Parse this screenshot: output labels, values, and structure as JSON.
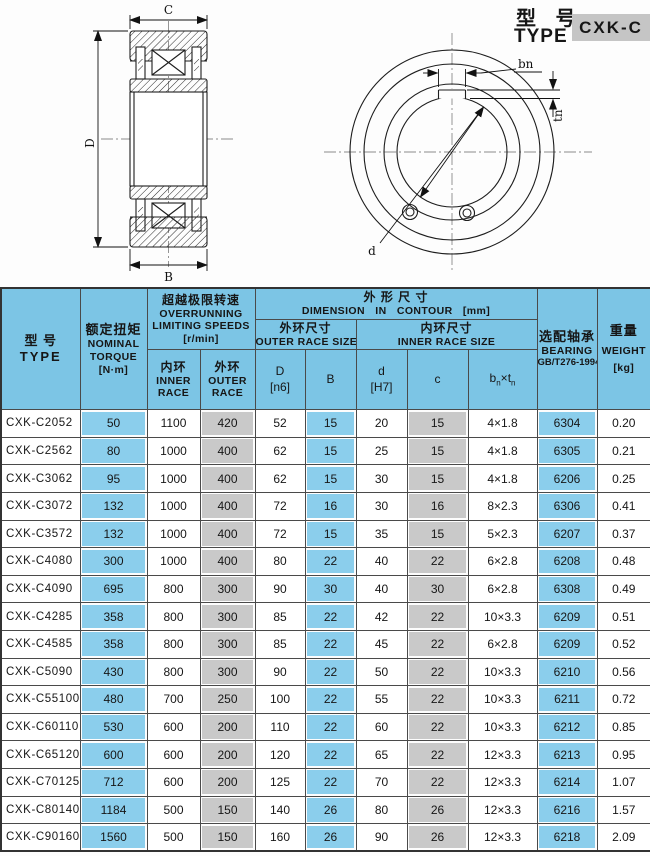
{
  "title": {
    "cn": "型 号",
    "en": "TYPE",
    "model": "CXK-C"
  },
  "drawing": {
    "labels": {
      "C": "C",
      "D": "D",
      "B": "B",
      "bn": "bn",
      "tn": "tn",
      "d": "d"
    }
  },
  "colors": {
    "header_blue": "#7CC5E5",
    "cell_blue": "#8BCEEC",
    "cell_gray": "#C9C9C9",
    "badge_gray": "#C5C5C5"
  },
  "table": {
    "header": {
      "type_cn": "型  号",
      "type_en": "TYPE",
      "torque_cn": "额定扭矩",
      "torque_l1": "NOMINAL",
      "torque_l2": "TORQUE",
      "torque_l3": "[N·m]",
      "overrun_cn": "超越极限转速",
      "overrun_l1": "OVERRUNNING",
      "overrun_l2": "LIMITING SPEEDS",
      "overrun_l3": "[r/min]",
      "inner_cn": "内环",
      "inner_l1": "INNER",
      "inner_l2": "RACE",
      "outer_cn": "外环",
      "outer_l1": "OUTER",
      "outer_l2": "RACE",
      "dim_cn": "外  形  尺  寸",
      "dim_en": "DIMENSION  IN  CONTOUR  [mm]",
      "outer_size_cn": "外环尺寸",
      "outer_size_en": "OUTER RACE SIZE",
      "inner_size_cn": "内环尺寸",
      "inner_size_en": "INNER RACE SIZE",
      "col_D_l1": "D",
      "col_D_l2": "[n6]",
      "col_B": "B",
      "col_d_l1": "d",
      "col_d_l2": "[H7]",
      "col_c": "c",
      "col_bt": {
        "base1": "b",
        "sub1": "n",
        "times": "×",
        "base2": "t",
        "sub2": "n"
      },
      "bearing_cn": "选配轴承",
      "bearing_l1": "BEARING",
      "bearing_l2": "GB/T276-1994",
      "weight_cn": "重量",
      "weight_l1": "WEIGHT",
      "weight_l2": "[kg]"
    },
    "rows": [
      {
        "type": "CXK-C2052",
        "torque": "50",
        "inner": "1100",
        "outer": "420",
        "D": "52",
        "B": "15",
        "d": "20",
        "c": "15",
        "bt": "4×1.8",
        "bearing": "6304",
        "weight": "0.20"
      },
      {
        "type": "CXK-C2562",
        "torque": "80",
        "inner": "1000",
        "outer": "400",
        "D": "62",
        "B": "15",
        "d": "25",
        "c": "15",
        "bt": "4×1.8",
        "bearing": "6305",
        "weight": "0.21"
      },
      {
        "type": "CXK-C3062",
        "torque": "95",
        "inner": "1000",
        "outer": "400",
        "D": "62",
        "B": "15",
        "d": "30",
        "c": "15",
        "bt": "4×1.8",
        "bearing": "6206",
        "weight": "0.25"
      },
      {
        "type": "CXK-C3072",
        "torque": "132",
        "inner": "1000",
        "outer": "400",
        "D": "72",
        "B": "16",
        "d": "30",
        "c": "16",
        "bt": "8×2.3",
        "bearing": "6306",
        "weight": "0.41"
      },
      {
        "type": "CXK-C3572",
        "torque": "132",
        "inner": "1000",
        "outer": "400",
        "D": "72",
        "B": "15",
        "d": "35",
        "c": "15",
        "bt": "5×2.3",
        "bearing": "6207",
        "weight": "0.37"
      },
      {
        "type": "CXK-C4080",
        "torque": "300",
        "inner": "1000",
        "outer": "400",
        "D": "80",
        "B": "22",
        "d": "40",
        "c": "22",
        "bt": "6×2.8",
        "bearing": "6208",
        "weight": "0.48"
      },
      {
        "type": "CXK-C4090",
        "torque": "695",
        "inner": "800",
        "outer": "300",
        "D": "90",
        "B": "30",
        "d": "40",
        "c": "30",
        "bt": "6×2.8",
        "bearing": "6308",
        "weight": "0.49"
      },
      {
        "type": "CXK-C4285",
        "torque": "358",
        "inner": "800",
        "outer": "300",
        "D": "85",
        "B": "22",
        "d": "42",
        "c": "22",
        "bt": "10×3.3",
        "bearing": "6209",
        "weight": "0.51"
      },
      {
        "type": "CXK-C4585",
        "torque": "358",
        "inner": "800",
        "outer": "300",
        "D": "85",
        "B": "22",
        "d": "45",
        "c": "22",
        "bt": "6×2.8",
        "bearing": "6209",
        "weight": "0.52"
      },
      {
        "type": "CXK-C5090",
        "torque": "430",
        "inner": "800",
        "outer": "300",
        "D": "90",
        "B": "22",
        "d": "50",
        "c": "22",
        "bt": "10×3.3",
        "bearing": "6210",
        "weight": "0.56"
      },
      {
        "type": "CXK-C55100",
        "torque": "480",
        "inner": "700",
        "outer": "250",
        "D": "100",
        "B": "22",
        "d": "55",
        "c": "22",
        "bt": "10×3.3",
        "bearing": "6211",
        "weight": "0.72"
      },
      {
        "type": "CXK-C60110",
        "torque": "530",
        "inner": "600",
        "outer": "200",
        "D": "110",
        "B": "22",
        "d": "60",
        "c": "22",
        "bt": "10×3.3",
        "bearing": "6212",
        "weight": "0.85"
      },
      {
        "type": "CXK-C65120",
        "torque": "600",
        "inner": "600",
        "outer": "200",
        "D": "120",
        "B": "22",
        "d": "65",
        "c": "22",
        "bt": "12×3.3",
        "bearing": "6213",
        "weight": "0.95"
      },
      {
        "type": "CXK-C70125",
        "torque": "712",
        "inner": "600",
        "outer": "200",
        "D": "125",
        "B": "22",
        "d": "70",
        "c": "22",
        "bt": "12×3.3",
        "bearing": "6214",
        "weight": "1.07"
      },
      {
        "type": "CXK-C80140",
        "torque": "1184",
        "inner": "500",
        "outer": "150",
        "D": "140",
        "B": "26",
        "d": "80",
        "c": "26",
        "bt": "12×3.3",
        "bearing": "6216",
        "weight": "1.57"
      },
      {
        "type": "CXK-C90160",
        "torque": "1560",
        "inner": "500",
        "outer": "150",
        "D": "160",
        "B": "26",
        "d": "90",
        "c": "26",
        "bt": "12×3.3",
        "bearing": "6218",
        "weight": "2.09"
      }
    ]
  }
}
